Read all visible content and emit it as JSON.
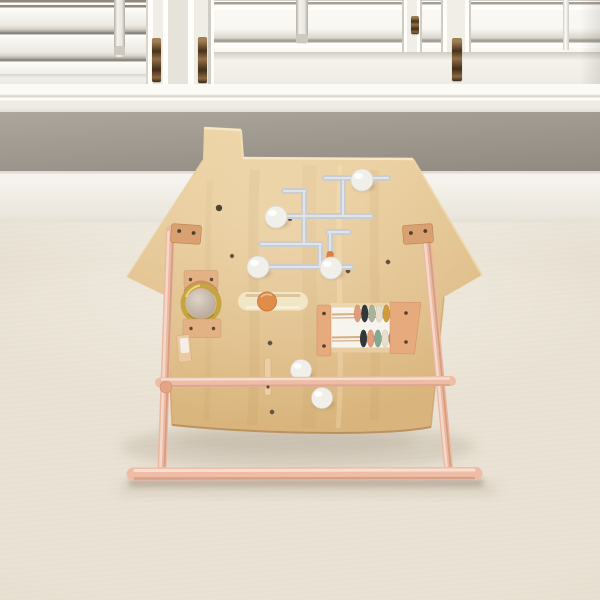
{
  "scene": {
    "setting": "playroom with white plantation shutters, gray wall and cream carpet",
    "subject": "house-shaped wooden activity busy-board on a pink easel stand"
  },
  "palette": {
    "wall_gray": "#a19a90",
    "shutter_white": "#f7f5f0",
    "baseboard_white": "#f2efe8",
    "carpet": "#eae3d5",
    "board_wood": "#e2c08c",
    "board_edge_light": "#f3e3ba",
    "leg_pink": "#ecb9a0",
    "floor_bar_pink": "#efbda6",
    "bracket_tan": "#d9a171",
    "track_gray": "#c9cdd2",
    "knob_white": "#f1efe9",
    "ring_gold": "#c6a43f",
    "mirror_silver": "#cfc3b6",
    "slider_orange": "#e08c4a",
    "leather_tan": "#c9915f",
    "hinge_bronze": "#6e4d2c",
    "screw_brown": "#5f4f3c",
    "shadow": "rgba(110,92,70,0.22)"
  },
  "maze": {
    "knob_count": 4,
    "bead_orange": "#d97f3f"
  },
  "abacus": {
    "bead_count": 11,
    "top_row": [
      "#e19c79",
      "#32373a",
      "#a9b39a",
      "#e8e0cc",
      "#cf9c3a",
      "#2e3336"
    ],
    "bottom_row": [
      "#32373a",
      "#e19c79",
      "#85a890",
      "#e8e0cc",
      "#b08a2a"
    ]
  }
}
